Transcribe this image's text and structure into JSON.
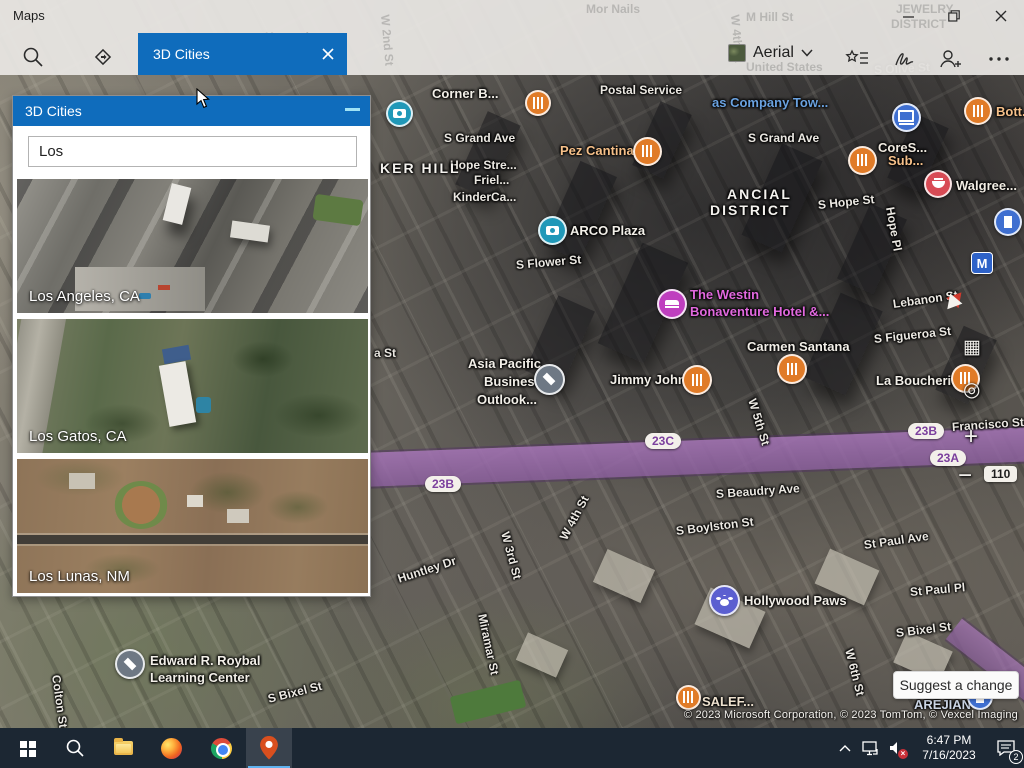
{
  "window": {
    "app_title": "Maps"
  },
  "topbar": {
    "tab_label": "3D Cities",
    "style_selector_label": "Aerial",
    "ghost_labels": [
      {
        "t": "Kenneth",
        "x": 265,
        "y": 30,
        "r": 0
      },
      {
        "t": "W 2nd St",
        "x": 392,
        "y": 14,
        "r": 85
      },
      {
        "t": "Mor Nails",
        "x": 586,
        "y": 2,
        "r": 0
      },
      {
        "t": "W 4th St",
        "x": 742,
        "y": 14,
        "r": 85
      },
      {
        "t": "M Hill St",
        "x": 746,
        "y": 10,
        "r": 0
      },
      {
        "t": "JEWELRY",
        "x": 896,
        "y": 2,
        "r": 0
      },
      {
        "t": "DISTRICT",
        "x": 891,
        "y": 17,
        "r": 0
      },
      {
        "t": "United States",
        "x": 746,
        "y": 60,
        "r": 0
      }
    ]
  },
  "panel": {
    "title": "3D Cities",
    "search_value": "Los",
    "cities": [
      {
        "name": "Los Angeles, CA"
      },
      {
        "name": "Los Gatos, CA"
      },
      {
        "name": "Los Lunas, NM"
      }
    ]
  },
  "map": {
    "streets": [
      {
        "t": "Postal Service",
        "x": 600,
        "y": 83,
        "r": 0
      },
      {
        "t": "S Olive St",
        "x": 874,
        "y": 63,
        "r": -3,
        "c": "#82827e"
      },
      {
        "t": "S Grand Ave",
        "x": 444,
        "y": 131,
        "r": 0
      },
      {
        "t": "S Grand Ave",
        "x": 748,
        "y": 131,
        "r": 0
      },
      {
        "t": "Hope Stre...",
        "x": 450,
        "y": 158,
        "r": 0
      },
      {
        "t": "Friel...",
        "x": 474,
        "y": 173,
        "r": 0
      },
      {
        "t": "KinderCa...",
        "x": 453,
        "y": 190,
        "r": 0
      },
      {
        "t": "S Hope St",
        "x": 818,
        "y": 198,
        "r": -6
      },
      {
        "t": "Hope Pl",
        "x": 890,
        "y": 200,
        "r": 80
      },
      {
        "t": "S Flower St",
        "x": 516,
        "y": 258,
        "r": -5
      },
      {
        "t": "Lebanon St",
        "x": 893,
        "y": 297,
        "r": -8
      },
      {
        "t": "S Figueroa St",
        "x": 874,
        "y": 332,
        "r": -6
      },
      {
        "t": "a St",
        "x": 374,
        "y": 346,
        "r": 0
      },
      {
        "t": "W 5th St",
        "x": 752,
        "y": 392,
        "r": 73
      },
      {
        "t": "Francisco St",
        "x": 952,
        "y": 420,
        "r": -4
      },
      {
        "t": "W 4th St",
        "x": 563,
        "y": 532,
        "r": -62
      },
      {
        "t": "S Beaudry Ave",
        "x": 716,
        "y": 487,
        "r": -4
      },
      {
        "t": "S Boylston St",
        "x": 676,
        "y": 524,
        "r": -7
      },
      {
        "t": "W 3rd St",
        "x": 505,
        "y": 525,
        "r": 75
      },
      {
        "t": "St Paul Ave",
        "x": 864,
        "y": 538,
        "r": -8
      },
      {
        "t": "Huntley Dr",
        "x": 398,
        "y": 572,
        "r": -18
      },
      {
        "t": "St Paul Pl",
        "x": 910,
        "y": 585,
        "r": -5
      },
      {
        "t": "Miramar St",
        "x": 482,
        "y": 607,
        "r": 78
      },
      {
        "t": "S Bixel St",
        "x": 896,
        "y": 626,
        "r": -7
      },
      {
        "t": "W 6th St",
        "x": 849,
        "y": 642,
        "r": 76
      },
      {
        "t": "Colton St",
        "x": 56,
        "y": 668,
        "r": 82
      },
      {
        "t": "S Bixel St",
        "x": 268,
        "y": 692,
        "r": -14
      }
    ],
    "districts": [
      {
        "t": "KER HILL",
        "x": 380,
        "y": 160
      },
      {
        "t": "ANCIAL",
        "x": 727,
        "y": 186
      },
      {
        "t": "DISTRICT",
        "x": 710,
        "y": 202
      }
    ],
    "pois": [
      {
        "lines": [
          {
            "t": "Corner B...",
            "x": 432,
            "y": 86
          }
        ],
        "c": "#f2efe8",
        "icon": {
          "type": "restaurant",
          "x": 538,
          "y": 103,
          "color": "#e07b28",
          "s": 26
        }
      },
      {
        "lines": [
          {
            "t": "Pez Cantina",
            "x": 560,
            "y": 143
          }
        ],
        "c": "#f6c089",
        "icon": {
          "type": "restaurant",
          "x": 647,
          "y": 151,
          "color": "#e07b28",
          "s": 29
        }
      },
      {
        "lines": [
          {
            "t": "as Company Tow...",
            "x": 712,
            "y": 95
          }
        ],
        "c": "#6aa2e0",
        "icon": null
      },
      {
        "lines": [
          {
            "t": "CoreS...",
            "x": 878,
            "y": 140
          }
        ],
        "c": "#efe9df",
        "icon": {
          "type": "laptop",
          "x": 906,
          "y": 117,
          "color": "#3f6fd0",
          "s": 29
        }
      },
      {
        "lines": [
          {
            "t": "Sub...",
            "x": 888,
            "y": 153
          }
        ],
        "c": "#f6c089",
        "icon": {
          "type": "restaurant",
          "x": 862,
          "y": 160,
          "color": "#e07b28",
          "s": 29
        }
      },
      {
        "lines": [
          {
            "t": "Bott...",
            "x": 996,
            "y": 104
          }
        ],
        "c": "#f6c089",
        "icon": {
          "type": "restaurant",
          "x": 978,
          "y": 111,
          "color": "#e07b28",
          "s": 28
        }
      },
      {
        "lines": [
          {
            "t": "Walgree...",
            "x": 956,
            "y": 178
          }
        ],
        "c": "#f2ede4",
        "icon": {
          "type": "bowl",
          "x": 938,
          "y": 184,
          "color": "#d84b55",
          "s": 28
        }
      },
      {
        "lines": [
          {
            "t": "ARCO Plaza",
            "x": 570,
            "y": 223
          }
        ],
        "c": "#f2efe8",
        "icon": {
          "type": "camera",
          "x": 552,
          "y": 230,
          "color": "#2098b8",
          "s": 29
        }
      },
      {
        "lines": [],
        "c": "",
        "icon": {
          "type": "camera",
          "x": 399,
          "y": 113,
          "color": "#2098b8",
          "s": 27
        }
      },
      {
        "lines": [
          {
            "t": "The Westin",
            "x": 690,
            "y": 287
          },
          {
            "t": "Bonaventure Hotel &...",
            "x": 690,
            "y": 304
          }
        ],
        "c": "#e168de",
        "icon": {
          "type": "hotel",
          "x": 672,
          "y": 304,
          "color": "#bf3fbf",
          "s": 30
        }
      },
      {
        "lines": [
          {
            "t": "Carmen Santana",
            "x": 747,
            "y": 339
          }
        ],
        "c": "#f2efe8",
        "icon": {
          "type": "restaurant",
          "x": 792,
          "y": 369,
          "color": "#e07b28",
          "s": 30
        }
      },
      {
        "lines": [
          {
            "t": "Asia Pacific",
            "x": 468,
            "y": 356
          },
          {
            "t": "Business",
            "x": 484,
            "y": 374
          },
          {
            "t": "Outlook...",
            "x": 477,
            "y": 392
          }
        ],
        "c": "#f2efe8",
        "icon": {
          "type": "school",
          "x": 549,
          "y": 379,
          "color": "#6e7884",
          "s": 31
        }
      },
      {
        "lines": [
          {
            "t": "Jimmy John's",
            "x": 610,
            "y": 372
          }
        ],
        "c": "#f2efe8",
        "icon": {
          "type": "restaurant",
          "x": 697,
          "y": 380,
          "color": "#e07b28",
          "s": 30
        }
      },
      {
        "lines": [
          {
            "t": "La Boucherie",
            "x": 876,
            "y": 373
          }
        ],
        "c": "#f2efe8",
        "icon": {
          "type": "restaurant",
          "x": 965,
          "y": 378,
          "color": "#e07b28",
          "s": 29
        }
      },
      {
        "lines": [
          {
            "t": "Hollywood Paws",
            "x": 744,
            "y": 593
          }
        ],
        "c": "#f2efe8",
        "icon": {
          "type": "paw",
          "x": 724,
          "y": 600,
          "color": "#5b5fd0",
          "s": 31
        }
      },
      {
        "lines": [
          {
            "t": "Edward R. Roybal",
            "x": 150,
            "y": 653
          },
          {
            "t": "Learning Center",
            "x": 150,
            "y": 670
          }
        ],
        "c": "#f2efe8",
        "icon": {
          "type": "school",
          "x": 130,
          "y": 664,
          "color": "#6e7884",
          "s": 30
        }
      },
      {
        "lines": [
          {
            "t": "SALEF...",
            "x": 702,
            "y": 694
          }
        ],
        "c": "#eee2cf",
        "icon": {
          "type": "restaurant",
          "x": 688,
          "y": 697,
          "color": "#e07b28",
          "s": 25
        }
      },
      {
        "lines": [
          {
            "t": "AREJIAN",
            "x": 914,
            "y": 697
          }
        ],
        "c": "#ccd6e6",
        "icon": {
          "type": "building",
          "x": 980,
          "y": 697,
          "color": "#3f6fd0",
          "s": 26
        }
      },
      {
        "lines": [],
        "c": "",
        "icon": {
          "type": "building",
          "x": 1008,
          "y": 222,
          "color": "#3f6fd0",
          "s": 28
        }
      },
      {
        "lines": [],
        "c": "",
        "icon": {
          "type": "metro",
          "x": 982,
          "y": 263,
          "color": "#2e62c8",
          "s": 22
        }
      }
    ],
    "shields": [
      {
        "t": "23C",
        "x": 645,
        "y": 433,
        "kind": "exit"
      },
      {
        "t": "23B",
        "x": 908,
        "y": 423,
        "kind": "exit"
      },
      {
        "t": "23A",
        "x": 930,
        "y": 450,
        "kind": "exit"
      },
      {
        "t": "23B",
        "x": 425,
        "y": 476,
        "kind": "exit"
      },
      {
        "t": "110",
        "x": 984,
        "y": 466,
        "kind": "hwy"
      }
    ],
    "controls": {
      "zoom_in": "+",
      "zoom_out": "−",
      "tilt_grid": "▦",
      "locate": "◎"
    },
    "suggest_label": "Suggest a change",
    "copyright": "© 2023 Microsoft Corporation, © 2023 TomTom, © Vexcel Imaging"
  },
  "taskbar": {
    "clock_time": "6:47 PM",
    "clock_date": "7/16/2023",
    "notification_count": "2"
  },
  "colors": {
    "accent_blue": "#0f6cbc",
    "freeway_purple": "#9a6cae",
    "poi_orange": "#e07b28",
    "poi_magenta": "#bf3fbf",
    "taskbar_bg": "#1c2733"
  }
}
